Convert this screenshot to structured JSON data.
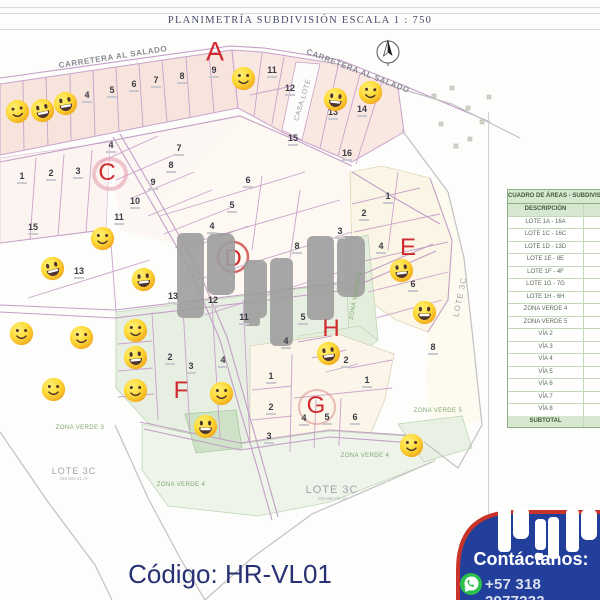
{
  "page": {
    "title": "PLANIMETRÍA SUBDIVISIÓN ESCALA 1 : 750",
    "code": "Código: HR-VL01"
  },
  "colors": {
    "accent_red": "#cf2a2e",
    "navy": "#233f9c",
    "smiley_yellow": "#fdd835",
    "zone_green": "#e6efe1",
    "lot_pink": "#f7e4dd",
    "table_green": "#d6e8d0",
    "whatsapp_green": "#2cbf4e"
  },
  "map": {
    "watermark": "PyP",
    "compass": "north-compass",
    "road_labels": [
      {
        "text": "CARRETERA AL SALADO",
        "x": 113,
        "y": 57,
        "rot": -9
      },
      {
        "text": "CARRETERA AL SALADO",
        "x": 358,
        "y": 71,
        "rot": 21
      }
    ],
    "casa_lote": {
      "text": "CASA LOTE",
      "x": 303,
      "y": 100,
      "rot": -73
    },
    "section_letters": [
      {
        "t": "A",
        "x": 215,
        "y": 52,
        "s": 27
      },
      {
        "t": "C",
        "x": 107,
        "y": 173,
        "s": 24
      },
      {
        "t": "E",
        "x": 408,
        "y": 248,
        "s": 24
      },
      {
        "t": "F",
        "x": 181,
        "y": 391,
        "s": 24
      },
      {
        "t": "G",
        "x": 316,
        "y": 406,
        "s": 24
      },
      {
        "t": "H",
        "x": 331,
        "y": 329,
        "s": 24
      }
    ],
    "hidden_letter": {
      "t": "D"
    },
    "lots": [
      {
        "n": "4",
        "x": 87,
        "y": 97
      },
      {
        "n": "5",
        "x": 112,
        "y": 92
      },
      {
        "n": "6",
        "x": 134,
        "y": 86
      },
      {
        "n": "7",
        "x": 156,
        "y": 82
      },
      {
        "n": "8",
        "x": 182,
        "y": 78
      },
      {
        "n": "9",
        "x": 214,
        "y": 72
      },
      {
        "n": "11",
        "x": 272,
        "y": 72
      },
      {
        "n": "12",
        "x": 290,
        "y": 90
      },
      {
        "n": "13",
        "x": 333,
        "y": 114
      },
      {
        "n": "14",
        "x": 362,
        "y": 111
      },
      {
        "n": "15",
        "x": 293,
        "y": 140
      },
      {
        "n": "16",
        "x": 347,
        "y": 155
      },
      {
        "n": "1",
        "x": 22,
        "y": 178
      },
      {
        "n": "2",
        "x": 51,
        "y": 175
      },
      {
        "n": "3",
        "x": 78,
        "y": 173
      },
      {
        "n": "4",
        "x": 111,
        "y": 147
      },
      {
        "n": "7",
        "x": 179,
        "y": 150
      },
      {
        "n": "8",
        "x": 171,
        "y": 167
      },
      {
        "n": "9",
        "x": 153,
        "y": 184
      },
      {
        "n": "10",
        "x": 135,
        "y": 203
      },
      {
        "n": "11",
        "x": 119,
        "y": 219
      },
      {
        "n": "15",
        "x": 33,
        "y": 229
      },
      {
        "n": "13",
        "x": 79,
        "y": 273
      },
      {
        "n": "6",
        "x": 248,
        "y": 182
      },
      {
        "n": "5",
        "x": 232,
        "y": 207
      },
      {
        "n": "4",
        "x": 212,
        "y": 228
      },
      {
        "n": "3",
        "x": 340,
        "y": 233
      },
      {
        "n": "8",
        "x": 297,
        "y": 248
      },
      {
        "n": "13",
        "x": 173,
        "y": 298
      },
      {
        "n": "12",
        "x": 213,
        "y": 302
      },
      {
        "n": "11",
        "x": 244,
        "y": 319
      },
      {
        "n": "5",
        "x": 303,
        "y": 319
      },
      {
        "n": "4",
        "x": 286,
        "y": 343
      },
      {
        "n": "1",
        "x": 388,
        "y": 198
      },
      {
        "n": "2",
        "x": 364,
        "y": 215
      },
      {
        "n": "4",
        "x": 381,
        "y": 248
      },
      {
        "n": "6",
        "x": 413,
        "y": 286
      },
      {
        "n": "2",
        "x": 170,
        "y": 359
      },
      {
        "n": "3",
        "x": 191,
        "y": 368
      },
      {
        "n": "4",
        "x": 223,
        "y": 362
      },
      {
        "n": "2",
        "x": 346,
        "y": 362
      },
      {
        "n": "1",
        "x": 271,
        "y": 378
      },
      {
        "n": "1",
        "x": 367,
        "y": 382
      },
      {
        "n": "2",
        "x": 271,
        "y": 409
      },
      {
        "n": "3",
        "x": 269,
        "y": 438
      },
      {
        "n": "4",
        "x": 304,
        "y": 420
      },
      {
        "n": "5",
        "x": 327,
        "y": 419
      },
      {
        "n": "6",
        "x": 355,
        "y": 419
      },
      {
        "n": "8",
        "x": 433,
        "y": 349
      }
    ],
    "smileys": [
      {
        "x": 17,
        "y": 111,
        "v": "dots",
        "r": -8
      },
      {
        "x": 42,
        "y": 110,
        "v": "grin",
        "r": -12
      },
      {
        "x": 65,
        "y": 103,
        "v": "grin",
        "r": -10
      },
      {
        "x": 243,
        "y": 78,
        "v": "dots",
        "r": 0
      },
      {
        "x": 335,
        "y": 99,
        "v": "grin",
        "r": 6
      },
      {
        "x": 370,
        "y": 92,
        "v": "dots",
        "r": 4
      },
      {
        "x": 102,
        "y": 238,
        "v": "dots",
        "r": 0
      },
      {
        "x": 52,
        "y": 268,
        "v": "grin",
        "r": -14
      },
      {
        "x": 143,
        "y": 279,
        "v": "grin",
        "r": -6
      },
      {
        "x": 21,
        "y": 333,
        "v": "dots",
        "r": 0
      },
      {
        "x": 81,
        "y": 337,
        "v": "dots",
        "r": 0
      },
      {
        "x": 53,
        "y": 389,
        "v": "dots",
        "r": 0
      },
      {
        "x": 135,
        "y": 330,
        "v": "dots",
        "r": 0
      },
      {
        "x": 135,
        "y": 357,
        "v": "grin",
        "r": -5
      },
      {
        "x": 135,
        "y": 390,
        "v": "dots",
        "r": 0
      },
      {
        "x": 205,
        "y": 426,
        "v": "grin",
        "r": 0
      },
      {
        "x": 221,
        "y": 393,
        "v": "dots",
        "r": 0
      },
      {
        "x": 328,
        "y": 353,
        "v": "grin",
        "r": -8
      },
      {
        "x": 401,
        "y": 270,
        "v": "grin",
        "r": -6
      },
      {
        "x": 424,
        "y": 312,
        "v": "grin",
        "r": 0
      },
      {
        "x": 411,
        "y": 445,
        "v": "dots",
        "r": 0
      }
    ],
    "zone_labels": [
      {
        "text": "ZONA VERDE 3",
        "x": 80,
        "y": 428,
        "rot": 0
      },
      {
        "text": "ZONA VERDE 4",
        "x": 181,
        "y": 485,
        "rot": 0
      },
      {
        "text": "ZONA VERDE 4",
        "x": 365,
        "y": 456,
        "rot": 0
      },
      {
        "text": "ZONA VERDE 5",
        "x": 438,
        "y": 411,
        "rot": 0
      },
      {
        "text": "ZONA VERDE 5",
        "x": 356,
        "y": 296,
        "rot": -80
      }
    ],
    "area_labels": [
      {
        "text": "LOTE 3C",
        "sub": "183.903.41 m²",
        "x": 74,
        "y": 474,
        "rot": 0,
        "s": 9
      },
      {
        "text": "LOTE 3C",
        "sub": "206.885.05 m²",
        "x": 332,
        "y": 493,
        "rot": 0,
        "s": 11
      },
      {
        "text": "LOTE 3C",
        "sub": "",
        "x": 460,
        "y": 297,
        "rot": -78,
        "s": 8
      }
    ]
  },
  "table": {
    "title": "CUADRO DE ÁREAS - SUBDIVISIÓN - LOTE",
    "header": "DESCRIPCIÓN",
    "rows": [
      "LOTE 1A - 16A",
      "LOTE 1C - 16C",
      "LOTE 1D - 13D",
      "LOTE 1E - 8E",
      "LOTE 1F - 4F",
      "LOTE 1G - 7G",
      "LOTE 1H - 6H",
      "ZONA VERDE 4",
      "ZONA VERDE 5",
      "VÍA 2",
      "VÍA 3",
      "VÍA 4",
      "VÍA 5",
      "VÍA 6",
      "VÍA 7",
      "VÍA 8"
    ],
    "footer": "SUBTOTAL"
  },
  "contact": {
    "brand": "PyP",
    "cta": "Contáctanos:",
    "phone": "+57 318 2977233"
  }
}
